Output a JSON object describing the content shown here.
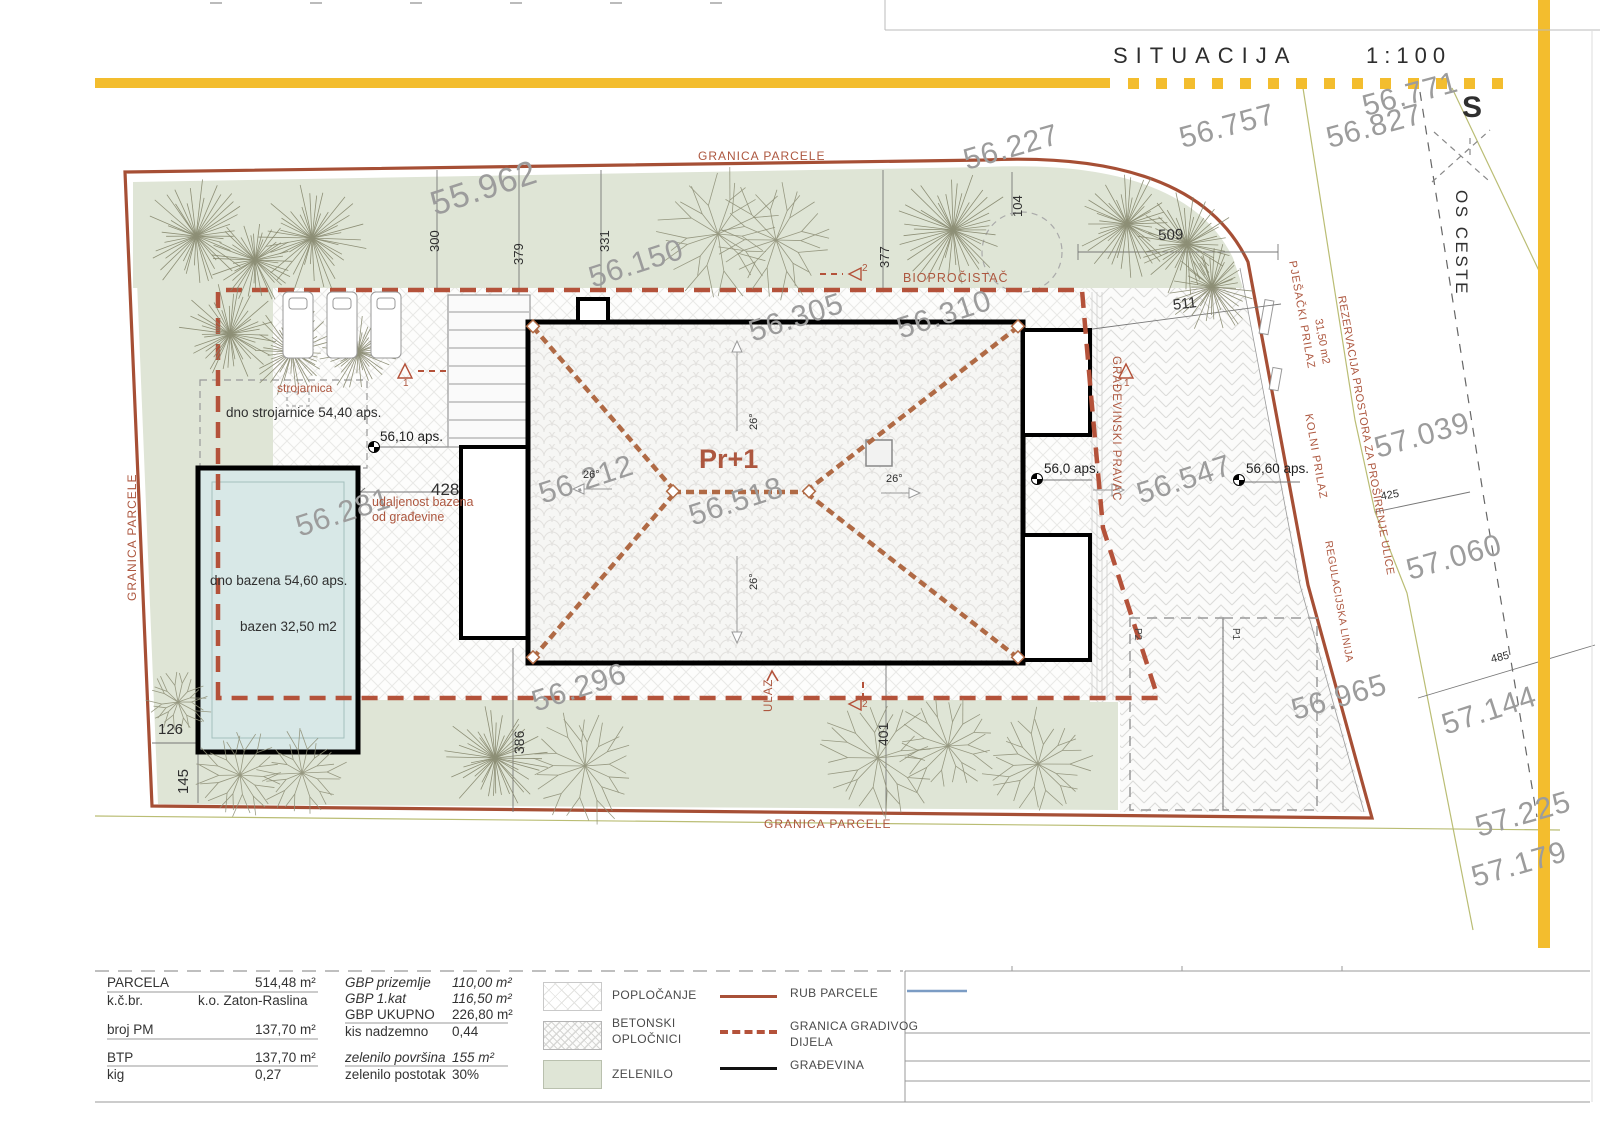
{
  "header": {
    "title": "SITUACIJA",
    "scale": "1:100"
  },
  "north": {
    "label": "S"
  },
  "building_label": {
    "t": "Pr+1",
    "x": 699,
    "y": 445,
    "s": 27
  },
  "colors": {
    "parcel_line": "#a64f35",
    "buildable_dash": "#b4523a",
    "building": "#000000",
    "greenery": "#dfe5d6",
    "pool_water": "#d8e8e7",
    "road_mark_yellow": "#f3bd2e",
    "elevation_gray": "#9c9c9c",
    "note_red": "#ad573f",
    "title_block_blue": "#7b9cc4"
  },
  "elevations": [
    {
      "t": "55.962",
      "x": 426,
      "y": 188,
      "r": -18,
      "s": 34
    },
    {
      "t": "56.150",
      "x": 585,
      "y": 264,
      "r": -18
    },
    {
      "t": "56.227",
      "x": 960,
      "y": 146,
      "r": -16
    },
    {
      "t": "56.757",
      "x": 1176,
      "y": 124,
      "r": -15
    },
    {
      "t": "56.771",
      "x": 1359,
      "y": 92,
      "r": -15
    },
    {
      "t": "56.827",
      "x": 1323,
      "y": 124,
      "r": -15
    },
    {
      "t": "56.305",
      "x": 745,
      "y": 318,
      "r": -18
    },
    {
      "t": "56.310",
      "x": 893,
      "y": 315,
      "r": -18
    },
    {
      "t": "56.212",
      "x": 535,
      "y": 480,
      "r": -18
    },
    {
      "t": "56.518",
      "x": 685,
      "y": 502,
      "r": -18
    },
    {
      "t": "56.281",
      "x": 292,
      "y": 513,
      "r": -18
    },
    {
      "t": "56.296",
      "x": 528,
      "y": 688,
      "r": -18
    },
    {
      "t": "56.547",
      "x": 1133,
      "y": 480,
      "r": -18
    },
    {
      "t": "56.965",
      "x": 1288,
      "y": 696,
      "r": -16
    },
    {
      "t": "57.039",
      "x": 1371,
      "y": 434,
      "r": -16
    },
    {
      "t": "57.060",
      "x": 1403,
      "y": 556,
      "r": -16
    },
    {
      "t": "57.144",
      "x": 1438,
      "y": 711,
      "r": -18
    },
    {
      "t": "57.225",
      "x": 1472,
      "y": 813,
      "r": -16
    },
    {
      "t": "57.179",
      "x": 1468,
      "y": 863,
      "r": -16
    }
  ],
  "dimensions": [
    {
      "t": "300",
      "x": 428,
      "y": 252,
      "r": -90,
      "s": 13
    },
    {
      "t": "379",
      "x": 512,
      "y": 265,
      "r": -90,
      "s": 13
    },
    {
      "t": "331",
      "x": 598,
      "y": 252,
      "r": -90,
      "s": 13
    },
    {
      "t": "377",
      "x": 878,
      "y": 268,
      "r": -90,
      "s": 13
    },
    {
      "t": "104",
      "x": 1011,
      "y": 217,
      "r": -90,
      "s": 13
    },
    {
      "t": "509",
      "x": 1158,
      "y": 228,
      "r": -2,
      "s": 15
    },
    {
      "t": "511",
      "x": 1172,
      "y": 298,
      "r": -7,
      "s": 15
    },
    {
      "t": "428",
      "x": 431,
      "y": 481,
      "r": 0,
      "s": 17
    },
    {
      "t": "126",
      "x": 158,
      "y": 722,
      "r": 0,
      "s": 15
    },
    {
      "t": "145",
      "x": 176,
      "y": 794,
      "r": -90,
      "s": 15
    },
    {
      "t": "386",
      "x": 512,
      "y": 754,
      "r": -90,
      "s": 14
    },
    {
      "t": "401",
      "x": 876,
      "y": 746,
      "r": -90,
      "s": 14
    },
    {
      "t": "425",
      "x": 1380,
      "y": 492,
      "r": -10,
      "s": 11
    },
    {
      "t": "485",
      "x": 1490,
      "y": 655,
      "r": -14,
      "s": 11
    }
  ],
  "slopes": [
    {
      "t": "26°",
      "x": 583,
      "y": 470,
      "r": 0
    },
    {
      "t": "26°",
      "x": 886,
      "y": 474,
      "r": 0
    },
    {
      "t": "26°",
      "x": 749,
      "y": 430,
      "r": -90
    },
    {
      "t": "26°",
      "x": 749,
      "y": 590,
      "r": -90
    }
  ],
  "red_labels": [
    {
      "t": "GRANICA PARCELE",
      "x": 698,
      "y": 150,
      "r": 0,
      "ls": 1
    },
    {
      "t": "GRANICA PARCELE",
      "x": 764,
      "y": 818,
      "r": 0,
      "ls": 1
    },
    {
      "t": "GRANICA PARCELE",
      "x": 126,
      "y": 601,
      "r": -90,
      "ls": 1
    },
    {
      "t": "BIOPROČISTAČ",
      "x": 903,
      "y": 272,
      "r": 0,
      "s": 12.5,
      "ls": 1
    },
    {
      "t": "strojarnica",
      "x": 277,
      "y": 382,
      "r": 0,
      "s": 12
    },
    {
      "t": "udaljenost bazena",
      "x": 372,
      "y": 496,
      "r": 0,
      "s": 12.5
    },
    {
      "t": "od građevine",
      "x": 372,
      "y": 511,
      "r": 0,
      "s": 12.5
    },
    {
      "t": "ULAZ",
      "x": 763,
      "y": 712,
      "r": -90,
      "s": 11.5,
      "ls": 1
    },
    {
      "t": "GRAĐEVINSKI PRAVAC",
      "x": 1122,
      "y": 356,
      "r": 90,
      "s": 11.5,
      "ls": 1
    },
    {
      "t": "PJEŠAČKI PRILAZ",
      "x": 1297,
      "y": 260,
      "r": 80,
      "s": 11,
      "ls": 1
    },
    {
      "t": "KOLNI PRILAZ",
      "x": 1313,
      "y": 413,
      "r": 80,
      "s": 11,
      "ls": 1
    },
    {
      "t": "REZERVACIJA PROSTORA ZA PROŠIRENJE ULICE",
      "x": 1346,
      "y": 295,
      "r": 80,
      "s": 11,
      "ls": 0.5
    },
    {
      "t": "31,50 m2",
      "x": 1323,
      "y": 318,
      "r": 80,
      "s": 11
    },
    {
      "t": "REGULACIJSKA LINIJA",
      "x": 1333,
      "y": 540,
      "r": 80,
      "s": 10.5,
      "ls": 0.5
    }
  ],
  "black_labels": [
    {
      "t": "dno strojarnice 54,40 aps.",
      "x": 226,
      "y": 406
    },
    {
      "t": "dno bazena 54,60 aps.",
      "x": 210,
      "y": 574
    },
    {
      "t": "bazen 32,50 m2",
      "x": 240,
      "y": 620
    },
    {
      "t": "OS CESTE",
      "x": 1470,
      "y": 190,
      "r": 90,
      "s": 17,
      "ls": 2.5
    },
    {
      "t": "S",
      "x": 1462,
      "y": 92,
      "s": 30,
      "b": 1
    }
  ],
  "spot_elevations": [
    {
      "t": "56,10 aps.",
      "x": 380,
      "y": 430,
      "mx": 374,
      "my": 447
    },
    {
      "t": "56,0 aps.",
      "x": 1044,
      "y": 462,
      "mx": 1037,
      "my": 479
    },
    {
      "t": "56,60 aps.",
      "x": 1246,
      "y": 462,
      "mx": 1239,
      "my": 480
    }
  ],
  "section_markers": [
    {
      "n": "1",
      "x": 398,
      "y": 364,
      "d": "up",
      "nx": 403,
      "ny": 379
    },
    {
      "n": "1",
      "x": 1119,
      "y": 364,
      "d": "up",
      "nx": 1124,
      "ny": 379
    },
    {
      "n": "2",
      "x": 849,
      "y": 268,
      "d": "left",
      "nx": 862,
      "ny": 264
    },
    {
      "n": "2",
      "x": 849,
      "y": 698,
      "d": "left",
      "nx": 862,
      "ny": 700
    }
  ],
  "parking_labels": [
    {
      "t": "P2",
      "x": 1142,
      "y": 628,
      "r": 90
    },
    {
      "t": "P1",
      "x": 1240,
      "y": 628,
      "r": 90
    }
  ],
  "stats_left": [
    {
      "label": "PARCELA",
      "value": "514,48 m²",
      "y": 976
    },
    {
      "label": "k.č.br.",
      "value": "k.o. Zaton-Raslina",
      "y": 994,
      "vx": 198
    },
    {
      "label": "broj PM",
      "value": "137,70 m²",
      "y": 1023
    },
    {
      "label": "BTP",
      "value": "137,70 m²",
      "y": 1051
    },
    {
      "label": "kig",
      "value": "0,27",
      "y": 1068
    }
  ],
  "stats_right": [
    {
      "label": "GBP prizemlje",
      "value": "110,00 m²",
      "y": 976,
      "i": 1
    },
    {
      "label": "GBP 1.kat",
      "value": "116,50 m²",
      "y": 992,
      "i": 1
    },
    {
      "label": "GBP UKUPNO",
      "value": "226,80 m²",
      "y": 1008
    },
    {
      "label": "kis nadzemno",
      "value": "0,44",
      "y": 1025
    },
    {
      "label": "zelenilo površina",
      "value": "155 m²",
      "y": 1051,
      "i": 1
    },
    {
      "label": "zelenilo postotak",
      "value": "30%",
      "y": 1068
    }
  ],
  "legend_areas": [
    {
      "sw": "pav",
      "y": 982,
      "l1": "POPLOČANJE",
      "y1": 989
    },
    {
      "sw": "herr",
      "y": 1021,
      "l1": "BETONSKI",
      "y1": 1017,
      "l2": "OPLOČNICI",
      "y2": 1033
    },
    {
      "sw": "green",
      "y": 1060,
      "l1": "ZELENILO",
      "y1": 1068
    }
  ],
  "legend_lines": [
    {
      "k": "solid-red",
      "y": 995,
      "l1": "RUB PARCELE",
      "y1": 987
    },
    {
      "k": "dash-red",
      "y": 1030,
      "l1": "GRANICA GRADIVOG",
      "y1": 1020,
      "l2": "DIJELA",
      "y2": 1036
    },
    {
      "k": "solid-black",
      "y": 1067,
      "l1": "GRAĐEVINA",
      "y1": 1059
    }
  ],
  "trees": [
    {
      "k": "p",
      "x": 196,
      "y": 236,
      "r": 58
    },
    {
      "k": "p",
      "x": 255,
      "y": 260,
      "r": 46
    },
    {
      "k": "p",
      "x": 312,
      "y": 238,
      "r": 56
    },
    {
      "k": "p",
      "x": 230,
      "y": 334,
      "r": 52
    },
    {
      "k": "p",
      "x": 292,
      "y": 352,
      "r": 48
    },
    {
      "k": "p",
      "x": 358,
      "y": 352,
      "r": 40
    },
    {
      "k": "p",
      "x": 953,
      "y": 230,
      "r": 64
    },
    {
      "k": "p",
      "x": 1127,
      "y": 224,
      "r": 55
    },
    {
      "k": "p",
      "x": 1187,
      "y": 244,
      "r": 55
    },
    {
      "k": "p",
      "x": 1212,
      "y": 287,
      "r": 46
    },
    {
      "k": "p",
      "x": 495,
      "y": 758,
      "r": 54
    },
    {
      "k": "b",
      "x": 718,
      "y": 234,
      "r": 60
    },
    {
      "k": "b",
      "x": 776,
      "y": 240,
      "r": 54
    },
    {
      "k": "b",
      "x": 585,
      "y": 766,
      "r": 56
    },
    {
      "k": "b",
      "x": 878,
      "y": 758,
      "r": 56
    },
    {
      "k": "b",
      "x": 948,
      "y": 746,
      "r": 48
    },
    {
      "k": "b",
      "x": 1038,
      "y": 764,
      "r": 50
    },
    {
      "k": "b",
      "x": 178,
      "y": 702,
      "r": 30
    },
    {
      "k": "b",
      "x": 240,
      "y": 775,
      "r": 44
    },
    {
      "k": "b",
      "x": 302,
      "y": 773,
      "r": 40
    }
  ],
  "loungers": [
    {
      "x": 283,
      "y": 292
    },
    {
      "x": 327,
      "y": 292
    },
    {
      "x": 371,
      "y": 292
    }
  ]
}
